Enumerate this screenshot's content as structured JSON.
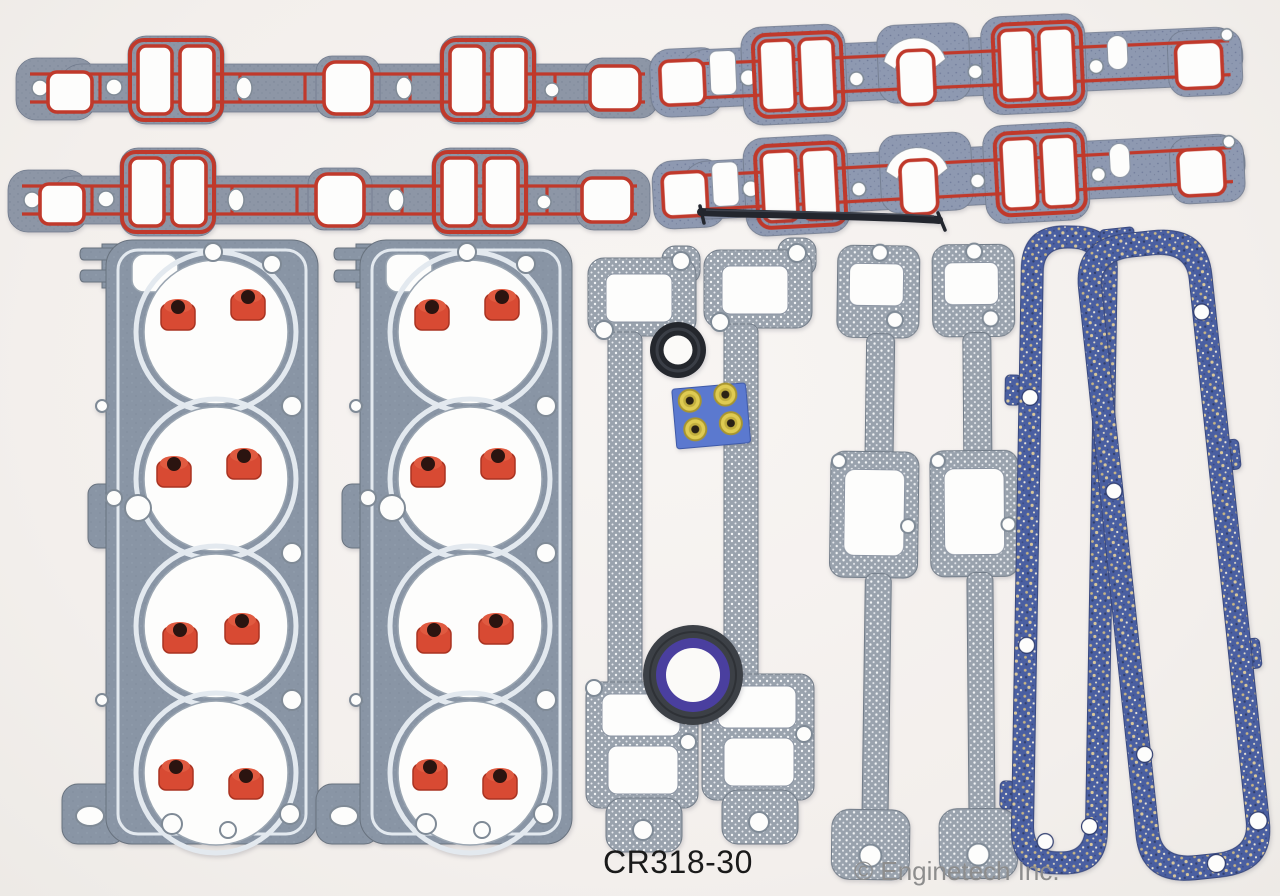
{
  "photo": {
    "kind": "product-photo",
    "subject": "complete engine gasket set laid out on a white background"
  },
  "caption": {
    "part_number": "CR318-30",
    "copyright": "© Enginetech Inc."
  },
  "colors": {
    "bg": "#f3efec",
    "bg_light": "#f8f5f3",
    "bg_dark": "#edeae6",
    "red_print": "#c0392b",
    "seal_red": "#d84a33",
    "emboss_white": "#e3e9ef",
    "steel_edge": "#727c88",
    "cutout_white": "#fdfdfc",
    "cork_blue": "#4a5fa1",
    "card_blue": "#5b79cf",
    "grommet_yellow": "#dfcb52",
    "rubber_black": "#23262e",
    "timing_ring_gray": "#3c4046",
    "timing_ring_blue": "#4a3f9f",
    "text_black": "#1a1a1a",
    "text_gray": "#8d8d8d"
  },
  "parts": [
    "intake-manifold-gasket-upper-left",
    "intake-manifold-gasket-lower-left",
    "intake-manifold-gasket-upper-right",
    "intake-manifold-gasket-lower-right",
    "intake-end-seal-strip",
    "cylinder-head-gasket-left",
    "cylinder-head-gasket-right",
    "valve-stem-seals-red",
    "exhaust-manifold-gasket-1",
    "exhaust-manifold-gasket-2",
    "exhaust-manifold-gasket-3",
    "exhaust-manifold-gasket-4",
    "water-outlet-seal-ring",
    "grommet-card-blue",
    "timing-cover-seal",
    "valve-cover-gasket-left",
    "valve-cover-gasket-right"
  ]
}
